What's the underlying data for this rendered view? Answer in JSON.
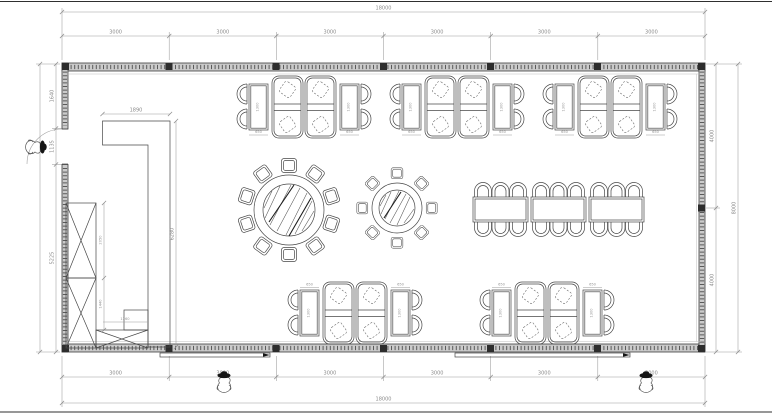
{
  "dims": {
    "top": {
      "overall": "18000",
      "segments": [
        "3000",
        "3000",
        "3000",
        "3000",
        "3000",
        "3000"
      ]
    },
    "bottom": {
      "overall": "18000",
      "segments": [
        "3000",
        "3000",
        "3000",
        "3000",
        "3000",
        "3000"
      ]
    },
    "left": {
      "segments": [
        "1640",
        "1135",
        "5225"
      ]
    },
    "right": {
      "overall": "8000",
      "segments": [
        "4000",
        "4000"
      ]
    },
    "partition": {
      "width": "1890",
      "height": "6280"
    },
    "cabinet": {
      "height_upper": "2050",
      "height_lower": "1440",
      "width": "1260"
    },
    "furniture": {
      "small_table_width": "650",
      "small_table_length": "1300"
    }
  },
  "colors": {
    "line": "#474747",
    "dim_line": "#9b9b9b",
    "dim_text": "#8a8a8a",
    "wall_fill": "#cbcbcb",
    "column": "#2d2d2d",
    "figure_hat": "#151515",
    "background": "#ffffff"
  }
}
